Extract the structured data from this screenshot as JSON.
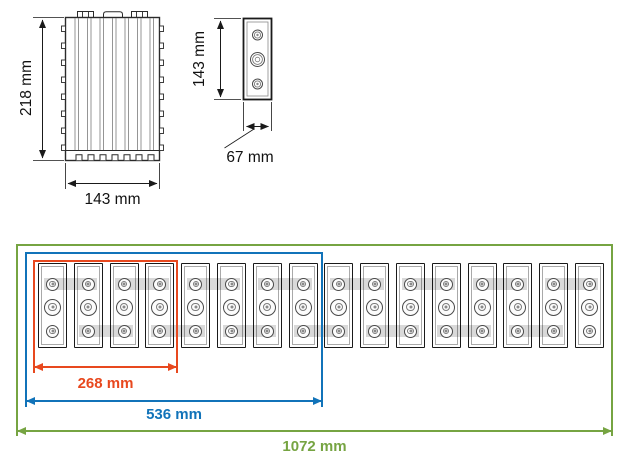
{
  "front_view": {
    "height_label": "218 mm",
    "width_label": "143 mm"
  },
  "side_view": {
    "height_label": "143 mm",
    "depth_label": "67 mm"
  },
  "array_view": {
    "cell_count": 16,
    "terminals_per_cell": 3,
    "dimensions": [
      {
        "label": "268 mm",
        "cells": 4,
        "color": "#e8481e"
      },
      {
        "label": "536 mm",
        "cells": 8,
        "color": "#1173b9"
      },
      {
        "label": "1072 mm",
        "cells": 16,
        "color": "#76a442"
      }
    ]
  },
  "colors": {
    "drawing_line": "#1a1a1a",
    "secondary_line": "#8a8a8a",
    "busbar_gray": "#d9d9d9"
  }
}
